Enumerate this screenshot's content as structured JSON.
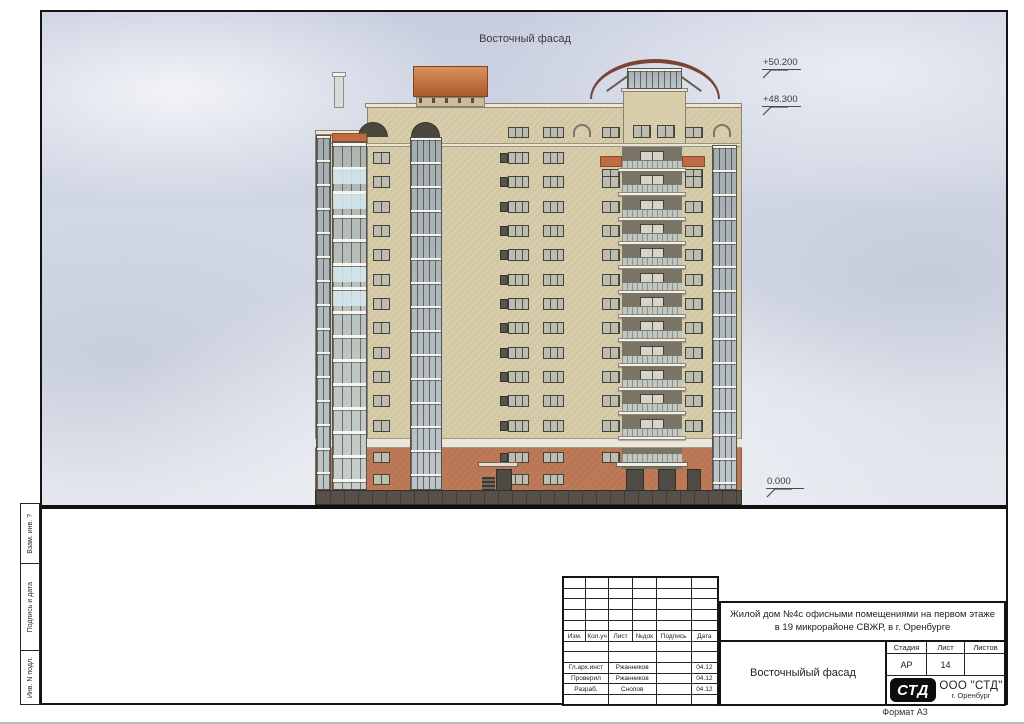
{
  "drawing": {
    "title": "Восточный фасад"
  },
  "levels": [
    {
      "label": "+50.200"
    },
    {
      "label": "+48.300"
    },
    {
      "label": "0.000"
    }
  ],
  "side_labels": {
    "vzam": "Взам. инв. ?",
    "podpis": "Подпись и дата",
    "inv": "Инв. N подл."
  },
  "title_block": {
    "project_line1": "Жилой дом №4с офисными помещениями на первом этаже",
    "project_line2": "в 19 микрорайоне СВЖР, в г. Оренбурге",
    "doc_title": "Восточныйый фасад",
    "headers": [
      "Изм.",
      "Кол.уч",
      "Лист",
      "№док",
      "Подпись",
      "Дата"
    ],
    "signatures": [
      {
        "role": "Гл.арх.инст",
        "name": "Ржанников",
        "sign": "",
        "date": "04.12"
      },
      {
        "role": "Проверил",
        "name": "Ржанников",
        "sign": "",
        "date": "04.12"
      },
      {
        "role": "Разраб.",
        "name": "Снопов",
        "sign": "",
        "date": "04.12"
      }
    ],
    "stage_label": "Стадия",
    "sheet_label": "Лист",
    "sheets_label": "Листов",
    "stage": "АР",
    "sheet": "14",
    "sheets": "",
    "logo_text": "СТД",
    "company": "ООО \"СТД\"",
    "city": "г. Оренбург",
    "format": "Формат А3"
  },
  "palette": {
    "sky_top": "#c8cedf",
    "sky_mid": "#d5dae6",
    "sky_bottom": "#e4e8ee",
    "wall_cream": "#d7cdaa",
    "accent_orange": "#bf6a42",
    "first_floor_orange": "#bd7a58",
    "roof_orange_light": "#d8925e",
    "roof_orange_dark": "#ad5a2b",
    "arch_brown": "#7b4236",
    "white_band": "#ebe8da",
    "plinth": "#57504a",
    "recess": "#7a7467",
    "railing": "#c2c6c0",
    "slab_white": "#f1f0e9",
    "door_dark": "#4f4b44"
  },
  "building": {
    "floors": 12,
    "floor_top": 89,
    "floor_height": 24.33,
    "blue_glass_floors": [
      1,
      2,
      5,
      6
    ],
    "accent_floors": [
      0
    ]
  }
}
